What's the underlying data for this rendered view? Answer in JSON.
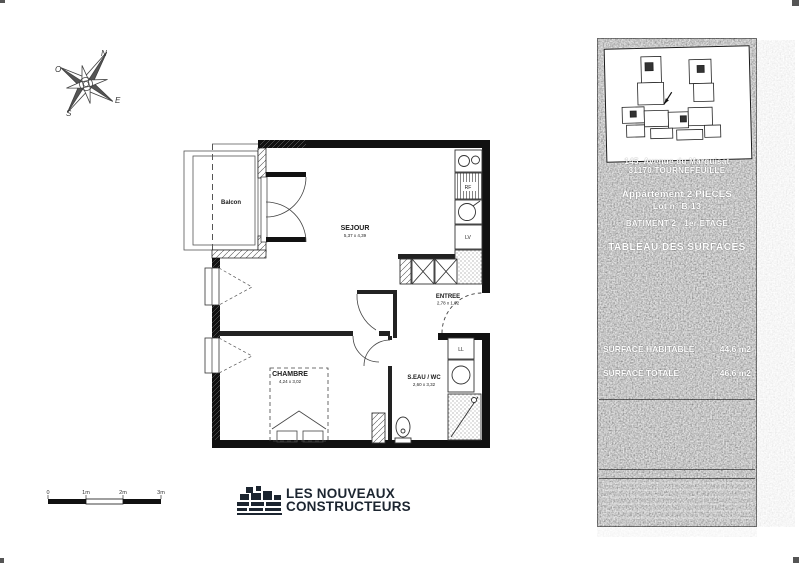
{
  "compass": {
    "n": "N",
    "o": "O",
    "e": "E",
    "s": "S"
  },
  "plan": {
    "balcon_label": "Balcon",
    "sejour_label": "SEJOUR",
    "sejour_dims": "5,37 x 4,39",
    "chambre_label": "CHAMBRE",
    "chambre_dims": "4,24 x 3,02",
    "entree_label": "ENTREE",
    "entree_dims": "2,78 x 1,92",
    "seau_label": "S.EAU / WC",
    "seau_dims": "2,60 x 3,32",
    "fridge_label": "RF",
    "dishwasher_label": "LV",
    "washer_label": "LL"
  },
  "scalebar": {
    "t0": "0",
    "t1": "1m",
    "t2": "2m",
    "t3": "3m"
  },
  "logo": {
    "line1": "LES NOUVEAUX",
    "line2": "CONSTRUCTEURS"
  },
  "panel": {
    "address_line1": "145, Avenue du Marquisat",
    "address_line2": "31170 TOURNEFEUILLE",
    "apartment_line": "Appartement 2 PIECES",
    "lot_line": "Lot n° B-13",
    "building_line": "BATIMENT 2 - 1er ETAGE",
    "table_title": "TABLEAU DES SURFACES",
    "surface_habitable_label": "SURFACE HABITABLE",
    "surface_habitable_value": "44.6 m2",
    "surface_totale_label": "SURFACE TOTALE",
    "surface_totale_value": "46.6 m2"
  }
}
